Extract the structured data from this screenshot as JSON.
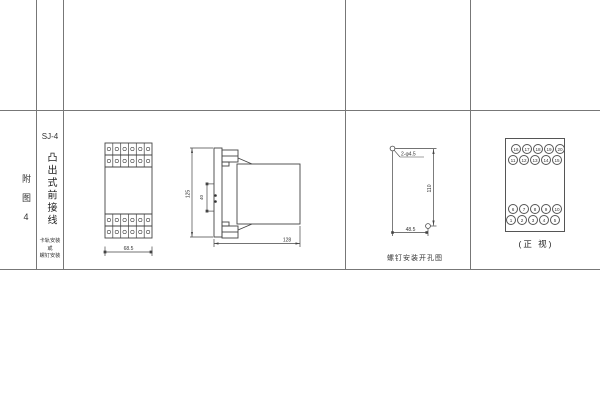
{
  "figure": {
    "margin_label": "附图4",
    "model": "SJ-4",
    "title": "凸出式前接线",
    "mount_notes": [
      "卡轨安装",
      "或",
      "螺钉安装"
    ]
  },
  "front_view": {
    "width": "68.5"
  },
  "side_view": {
    "height": "125",
    "depth": "128",
    "flange_holes_span": "40"
  },
  "drill_diagram": {
    "holes_label": "2-φ4.5",
    "height": "110",
    "width": "48.5",
    "caption": "螺钉安装开孔图"
  },
  "terminal_panel": {
    "caption": "(正 视)",
    "rows": [
      {
        "values": [
          "16",
          "17",
          "18",
          "19",
          "20"
        ]
      },
      {
        "values": [
          "11",
          "12",
          "13",
          "14",
          "15"
        ]
      },
      {
        "values": [
          "6",
          "7",
          "8",
          "9",
          "10"
        ]
      },
      {
        "values": [
          "1",
          "2",
          "3",
          "4",
          "5"
        ]
      }
    ]
  }
}
